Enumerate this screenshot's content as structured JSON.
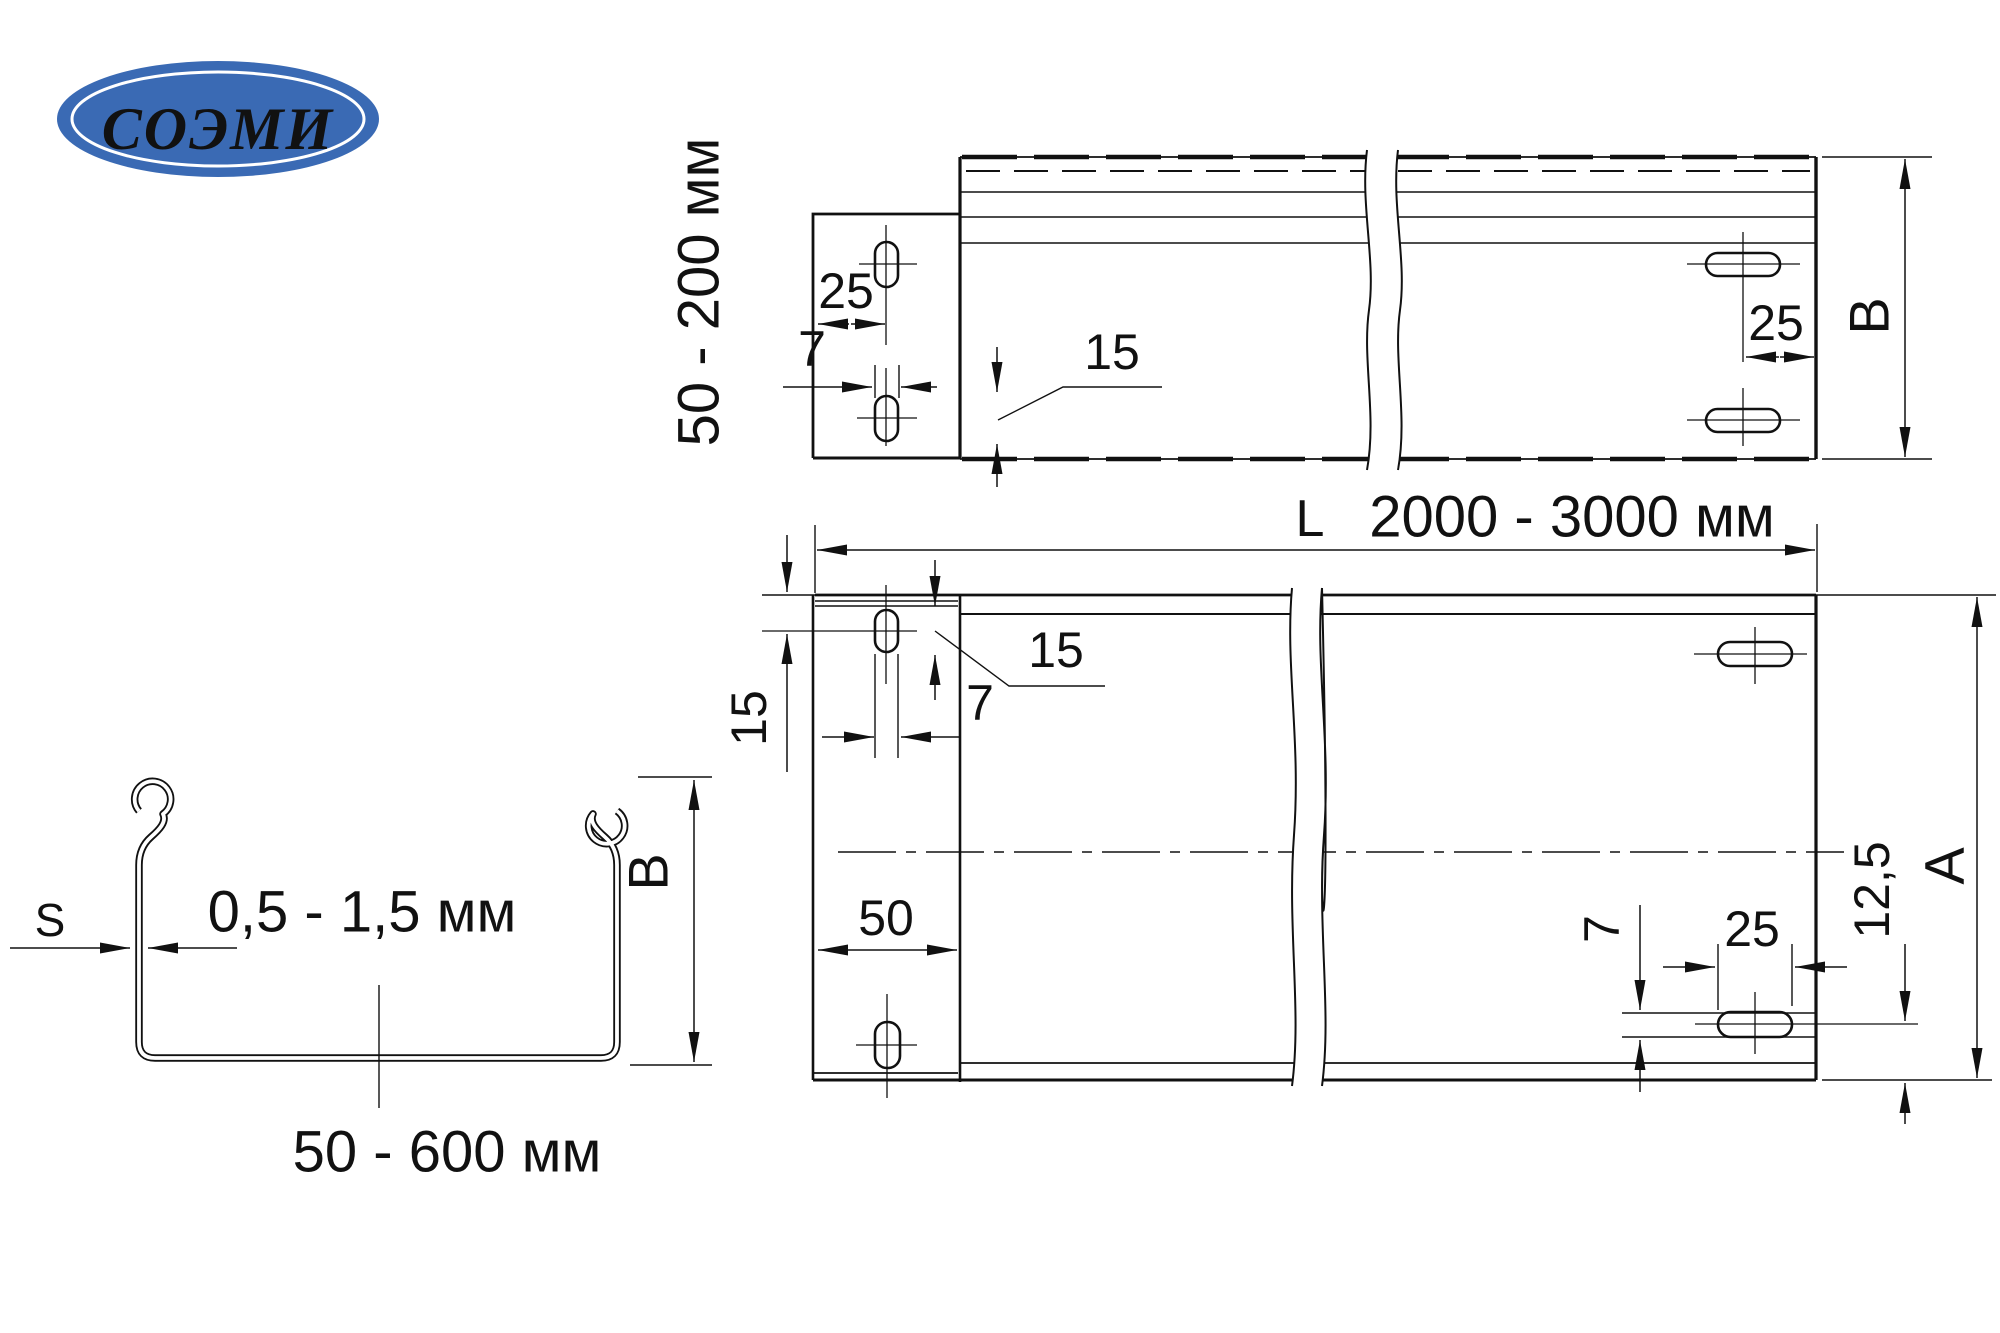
{
  "colors": {
    "ink": "#111111",
    "paper": "#ffffff",
    "logo_blue": "#3a6ab4",
    "logo_text_color": "#ffffff"
  },
  "logo": {
    "text": "СОЭМИ"
  },
  "side_view": {
    "height_range_label": "50 - 200 мм",
    "tab_slot_offset": "25",
    "tab_slot_width": "7",
    "slot_length_callout": "15",
    "end_slot_offset": "25",
    "height_letter": "B"
  },
  "plan_view": {
    "length_letter": "L",
    "length_range_label": "2000 - 3000 мм",
    "edge_to_slot_offset": "15",
    "slot_length_callout": "15",
    "tab_slot_width": "7",
    "tab_depth": "50",
    "end_slot_width": "7",
    "end_slot_length": "25",
    "slot_edge_offset": "12,5",
    "width_letter": "A"
  },
  "cross_section": {
    "thickness_letter": "S",
    "thickness_range_label": "0,5 - 1,5 мм",
    "width_range_label": "50 - 600 мм",
    "height_letter": "B"
  }
}
